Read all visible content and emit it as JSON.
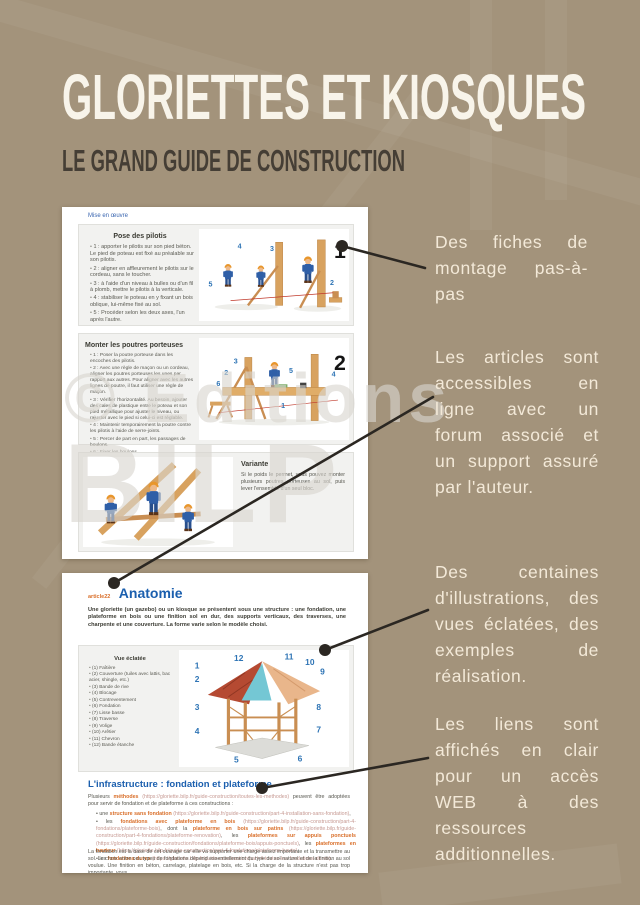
{
  "poster": {
    "title": "GLORIETTES ET KIOSQUES",
    "subtitle": "LE GRAND GUIDE DE CONSTRUCTION",
    "watermark": {
      "line1": "© Editions",
      "line2": "BILP"
    },
    "colors": {
      "background": "#a3937b",
      "callout_text": "#f3e9d8",
      "connector": "#2b2722",
      "accent_blue": "#2e74b5",
      "accent_orange": "#d96f2a"
    }
  },
  "callouts": [
    {
      "text": "Des fiches de montage pas-à-pas"
    },
    {
      "text": "Les articles sont accessibles en ligne avec un forum associé et un support assuré par l'auteur."
    },
    {
      "text": "Des centaines d'illustrations, des vues éclatées, des exemples de réalisation."
    },
    {
      "text": "Les liens sont affichés en clair pour un accès WEB à des ressources additionnelles."
    }
  ],
  "page1": {
    "nav_link": "Mise en œuvre",
    "sections": [
      {
        "number": "1",
        "title": "Pose des pilotis",
        "steps": [
          "1 : apporter le pilotis sur son pied béton. Le pied de poteau est fixé au préalable sur son pilotis.",
          "2 : aligner en affleurement le pilotis sur le cordeau, sans le toucher.",
          "3 : à l'aide d'un niveau à bulles ou d'un fil à plomb, mettre le pilotis à la verticale.",
          "4 : stabiliser le poteau en y fixant un bois oblique, lui-même fixé au sol.",
          "5 : Procéder selon les deux axes, l'un après l'autre."
        ],
        "fig_numbers": [
          "4",
          "3",
          "5",
          "2"
        ]
      },
      {
        "number": "2",
        "title": "Monter les poutres porteuses",
        "steps": [
          "1 : Poser la poutre porteuse dans les encoches des pilotis.",
          "2 : Avec une règle de maçon ou un cordeau, aligner les poutres porteuses les unes par rapport aux autres. Pour aligner avec les autres lignes de poutre, il faut utiliser une règle de maçon.",
          "3 : Vérifier l'horizontalité. Au besoin, ajouter des cales de plastique entre le poteau et son pied métallique pour ajuster le niveau, ou rajuster avec le pied si celui-ci est réglable.",
          "4 : Maintenir temporairement la poutre contre les pilotis à l'aide de serre-joints.",
          "5 : Percer de part en part, les passages de boulons.",
          "6 : Fixer les boulons."
        ],
        "fig_numbers": [
          "3",
          "2",
          "5",
          "4",
          "6",
          "1"
        ]
      },
      {
        "title": "Variante",
        "text": "Si le poids le permet, vous pouvez monter plusieurs poutres porteuses au sol, puis lever l'ensemble d'un seul bloc."
      }
    ]
  },
  "page2": {
    "article_tag": "article22",
    "article_title": "Anatomie",
    "intro": "Une gloriette (un gazebo) ou un kiosque se présentent sous une structure : une fondation, une plateforme en bois ou une finition sol en dur, des supports verticaux, des traverses, une charpente et une couverture. La forme varie selon le modèle choisi.",
    "exploded": {
      "label": "Vue éclatée",
      "parts": [
        "(1) Faîtière",
        "(2) Couverture (tuiles avec lattis, bac acier, shingle, etc.)",
        "(3) Bande de rive",
        "(4) Blocage",
        "(5) Contreventement",
        "(6) Fondation",
        "(7) Lisse basse",
        "(8) Traverse",
        "(9) Volige",
        "(10) Arêtier",
        "(11) Chevron",
        "(12) Bande étanche"
      ],
      "numbers": [
        "1",
        "2",
        "3",
        "4",
        "5",
        "6",
        "7",
        "8",
        "9",
        "10",
        "11",
        "12"
      ]
    },
    "infra": {
      "title": "L'infrastructure : fondation et plateforme",
      "intro_pre": "Plusieurs ",
      "intro_link": "méthodes",
      "intro_url": " (https://gloriette.bilp.fr/guide-construction/toutes-les-methodes)",
      "intro_post": " peuvent être adoptées pour servir de fondation et de plateforme à ces constructions :",
      "items": [
        {
          "pre": "une ",
          "link": "structure sans fondation",
          "url": " (https://gloriette.bilp.fr/guide-construction/part-4-installation-sans-fondation)",
          "tail": ","
        },
        {
          "pre": "les ",
          "link": "fondations avec plateforme en bois",
          "url": " (https://gloriette.bilp.fr/guide-construction/part-4-fondations/plateforme-bois)",
          "mid": ", dont la ",
          "link2": "plateforme en bois sur patins",
          "url2": " (https://gloriette.bilp.fr/guide-construction/part-4-fondations/plateforme-renovation)",
          "mid2": ", les ",
          "link3": "plateformes sur appuis ponctuels",
          "url3": " (https://gloriette.bilp.fr/guide-construction/fondations/plateforme-bois/appuis-ponctuels)",
          "mid3": ", les ",
          "link4": "plateformes en hauteur",
          "url4": " (https://gloriette.bilp.fr/guide-construction/part-4-fondations/plateforme-haute)",
          "tail": ","
        },
        {
          "pre": "les ",
          "link": "fondations dures",
          "url": " (https://gloriette.bilp.fr/guide-construction/part-4-toutes-les-fondations-dures)",
          "tail": "."
        }
      ],
      "footer": "La fondation est la base de cet ouvrage car elle va supporter une charge assez importante et la transmettre au sol. Le choix entre ces types de fondations dépend essentiellement du type de sol naturel et de la finition au sol voulue. Une finition en béton, carrelage, platelage en bois, etc. Si la charge de la structure n'est pas trop importante, vous ..."
    }
  }
}
